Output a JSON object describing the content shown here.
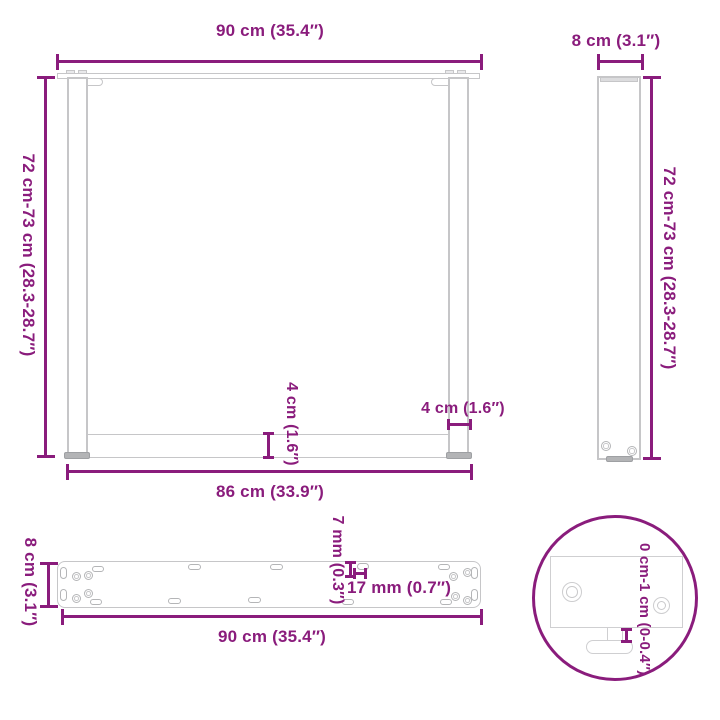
{
  "title": "Table legs dimension diagram",
  "colors": {
    "accent": "#8A1C7C",
    "outline": "#c6c6c8",
    "outline_dark": "#9ea0a3"
  },
  "front_view": {
    "top_width_label": "90 cm (35.4″)",
    "height_label": "72 cm-73 cm (28.3-28.7″)",
    "bottom_width_label": "86 cm (33.9″)",
    "crossbar_height_label": "4 cm (1.6″)",
    "post_width_label": "4 cm (1.6″)"
  },
  "side_view": {
    "width_label": "8 cm (3.1″)",
    "height_label": "72 cm-73 cm (28.3-28.7″)"
  },
  "plate_view": {
    "depth_label": "8 cm (3.1″)",
    "length_label": "90 cm (35.4″)",
    "hole_height_label": "7 mm (0.3″)",
    "hole_width_label": "17 mm (0.7″)"
  },
  "detail_view": {
    "adjustable_foot_label": "0 cm-1 cm (0-0.4″)"
  }
}
